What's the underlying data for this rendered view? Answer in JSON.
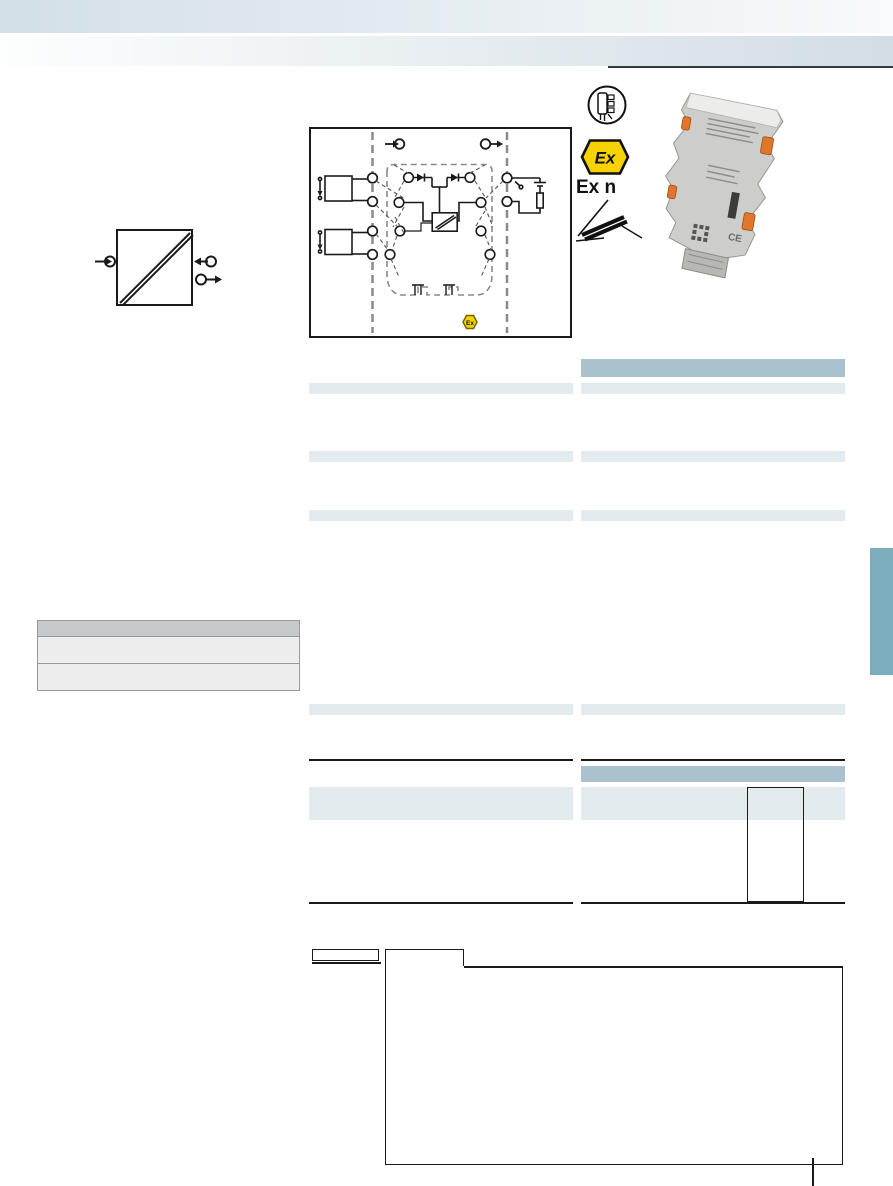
{
  "document": {
    "kind": "product-datasheet-page",
    "note": "signal conditioner / isolation amplifier datasheet; text layer not rendered in pixels"
  },
  "colors": {
    "band1_left": "#d3dfe7",
    "band1_right": "#f8fafb",
    "band2_left": "#fdfefe",
    "band2_right": "#d2dde4",
    "header_rule": "#333b3f",
    "table_header": "#a9c2ce",
    "table_row": "#e4ebee",
    "side_tab": "#7badbc",
    "left_table_header": "#c6c8ca",
    "left_table_row": "#ededee",
    "left_table_border": "#97999c",
    "rule_black": "#1a1a1a",
    "ex_yellow": "#f6d300",
    "diagram_line": "#1a1a1a",
    "diagram_dash": "#8a8a8a",
    "module_body": "#cdcecb",
    "module_edge": "#96978f",
    "module_top": "#ecedea",
    "module_clip": "#e0762b"
  },
  "approvals": {
    "atex_logo_text": "Ex",
    "protection_marking": "Ex n"
  },
  "block_diagram": {
    "zones": "input | isolation | output, separated by dashed lines",
    "ex_badge_text": "Ex"
  },
  "product_photo": {
    "description": "grey DIN-rail signal conditioner module with orange push-in levers",
    "ce_mark": "CE"
  },
  "tables": {
    "middle_column_highlight_rows": 5,
    "right_column_highlight_rows": 5,
    "right_column_header_bars": 2
  }
}
